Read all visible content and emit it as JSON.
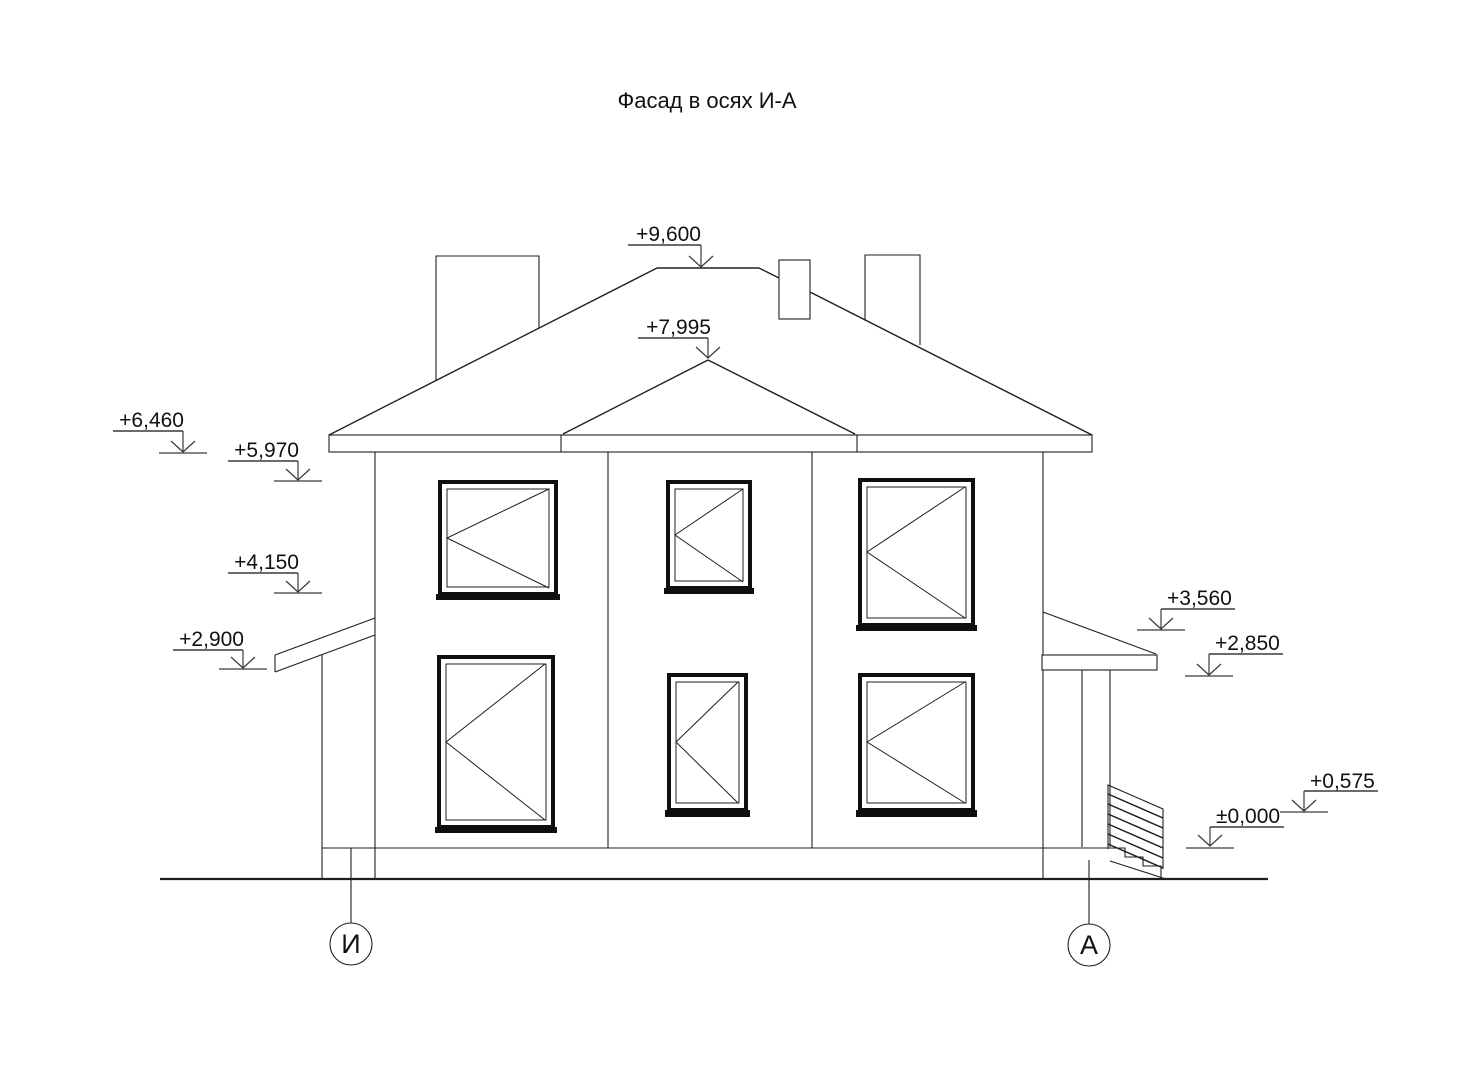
{
  "title": "Фасад в осях И-А",
  "style": {
    "ink": "#1f1f1f",
    "background": "#ffffff"
  },
  "drawing": {
    "axis_markers": [
      {
        "label": "И"
      },
      {
        "label": "А"
      }
    ],
    "elevation_marks": {
      "ridge": "+9,600",
      "bay_hip": "+7,995",
      "eaves": "+6,460",
      "wall_top": "+5,970",
      "floor2_window_sill": "+4,150",
      "side_canopy": "+2,900",
      "porch_roof": "+3,560",
      "porch_ceiling": "+2,850",
      "entrance_landing": "+0,575",
      "ground_floor": "±0,000"
    }
  }
}
